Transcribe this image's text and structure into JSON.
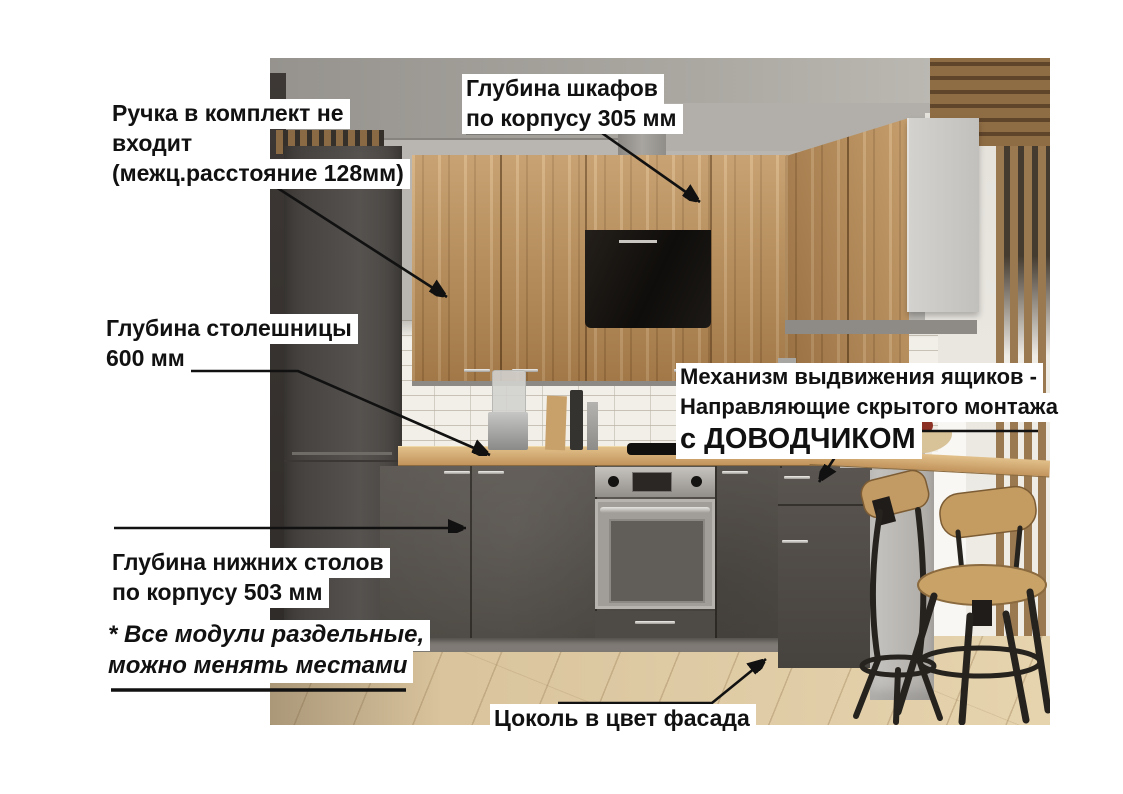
{
  "annotations": {
    "handle_note": {
      "lines": [
        "Ручка в комплект не",
        "входит",
        "(межц.расстояние 128мм)"
      ]
    },
    "upper_depth": {
      "lines": [
        "Глубина шкафов",
        "по корпусу 305 мм"
      ]
    },
    "countertop_depth": {
      "lines": [
        "Глубина столешницы",
        "600 мм"
      ]
    },
    "drawer_mechanism": {
      "lines": [
        "Механизм выдвижения ящиков -",
        "Направляющие скрытого монтажа"
      ],
      "emphasis": "с ДОВОДЧИКОМ"
    },
    "base_depth": {
      "lines": [
        "Глубина нижних столов",
        "по корпусу 503 мм"
      ]
    },
    "modules_note": {
      "lines": [
        "* Все модули раздельные,",
        "можно менять местами"
      ]
    },
    "plinth_note": {
      "text": "Цоколь в цвет фасада"
    }
  },
  "colors": {
    "label_bg": "#ffffff",
    "annotation_text": "#111111",
    "arrow": "#111111",
    "wood_facade": "#b68a56",
    "dark_facade": "#55504b",
    "countertop": "#c99a61",
    "brick_backsplash": "#f2efe8",
    "floor": "#dcc69e"
  }
}
